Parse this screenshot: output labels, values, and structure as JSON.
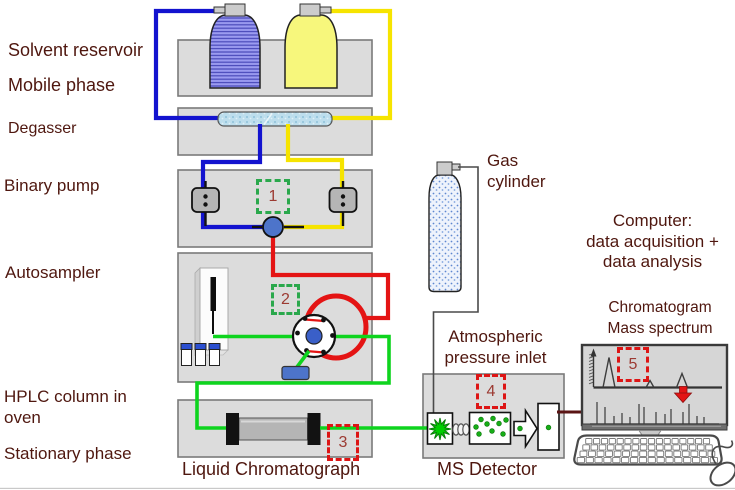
{
  "labels": {
    "solvent_reservoir": "Solvent reservoir",
    "mobile_phase": "Mobile phase",
    "degasser": "Degasser",
    "binary_pump": "Binary pump",
    "autosampler": "Autosampler",
    "hplc_column_in_oven": "HPLC column in oven",
    "stationary_phase": "Stationary phase",
    "liquid_chromatograph": "Liquid Chromatograph",
    "gas_cylinder": "Gas cylinder",
    "computer_lines": [
      "Computer:",
      "data acquisition +",
      "data analysis"
    ],
    "atmospheric_inlet_lines": [
      "Atmospheric",
      "pressure inlet"
    ],
    "ms_detector": "MS Detector",
    "chromatogram": "Chromatogram",
    "mass_spectrum": "Mass spectrum"
  },
  "markers": {
    "m1": {
      "number": "1",
      "accent": "green",
      "component": "binary pump mixer"
    },
    "m2": {
      "number": "2",
      "accent": "green",
      "component": "autosampler injection valve"
    },
    "m3": {
      "number": "3",
      "accent": "red",
      "component": "column outlet"
    },
    "m4": {
      "number": "4",
      "accent": "red",
      "component": "atmospheric pressure inlet"
    },
    "m5": {
      "number": "5",
      "accent": "red",
      "component": "data display"
    }
  },
  "colors": {
    "label_text": "#4f170f",
    "marker_number": "#9c3a32",
    "green_dashed": "#2aa84c",
    "red_dashed": "#dd1515",
    "tube_blue": "#1313cf",
    "tube_yellow": "#f6e400",
    "tube_red": "#e41414",
    "tube_green": "#0ed41e",
    "data_cable": "#5a1414",
    "equipment_fill": "#dcdcdc"
  },
  "monitor": {
    "chromatogram_peaks": [
      {
        "x": 609,
        "height": 30,
        "halfwidth": 6
      },
      {
        "x": 650,
        "height": 7,
        "halfwidth": 4
      },
      {
        "x": 682,
        "height": 14,
        "halfwidth": 5.5
      }
    ],
    "mass_spectrum_lines": [
      [
        597,
        22
      ],
      [
        605,
        17
      ],
      [
        614,
        8
      ],
      [
        622,
        11
      ],
      [
        630,
        7
      ],
      [
        639,
        20
      ],
      [
        644,
        17
      ],
      [
        656,
        12
      ],
      [
        665,
        10
      ],
      [
        671,
        15
      ],
      [
        683,
        12
      ],
      [
        689,
        20
      ],
      [
        697,
        8
      ],
      [
        704,
        7
      ]
    ]
  }
}
